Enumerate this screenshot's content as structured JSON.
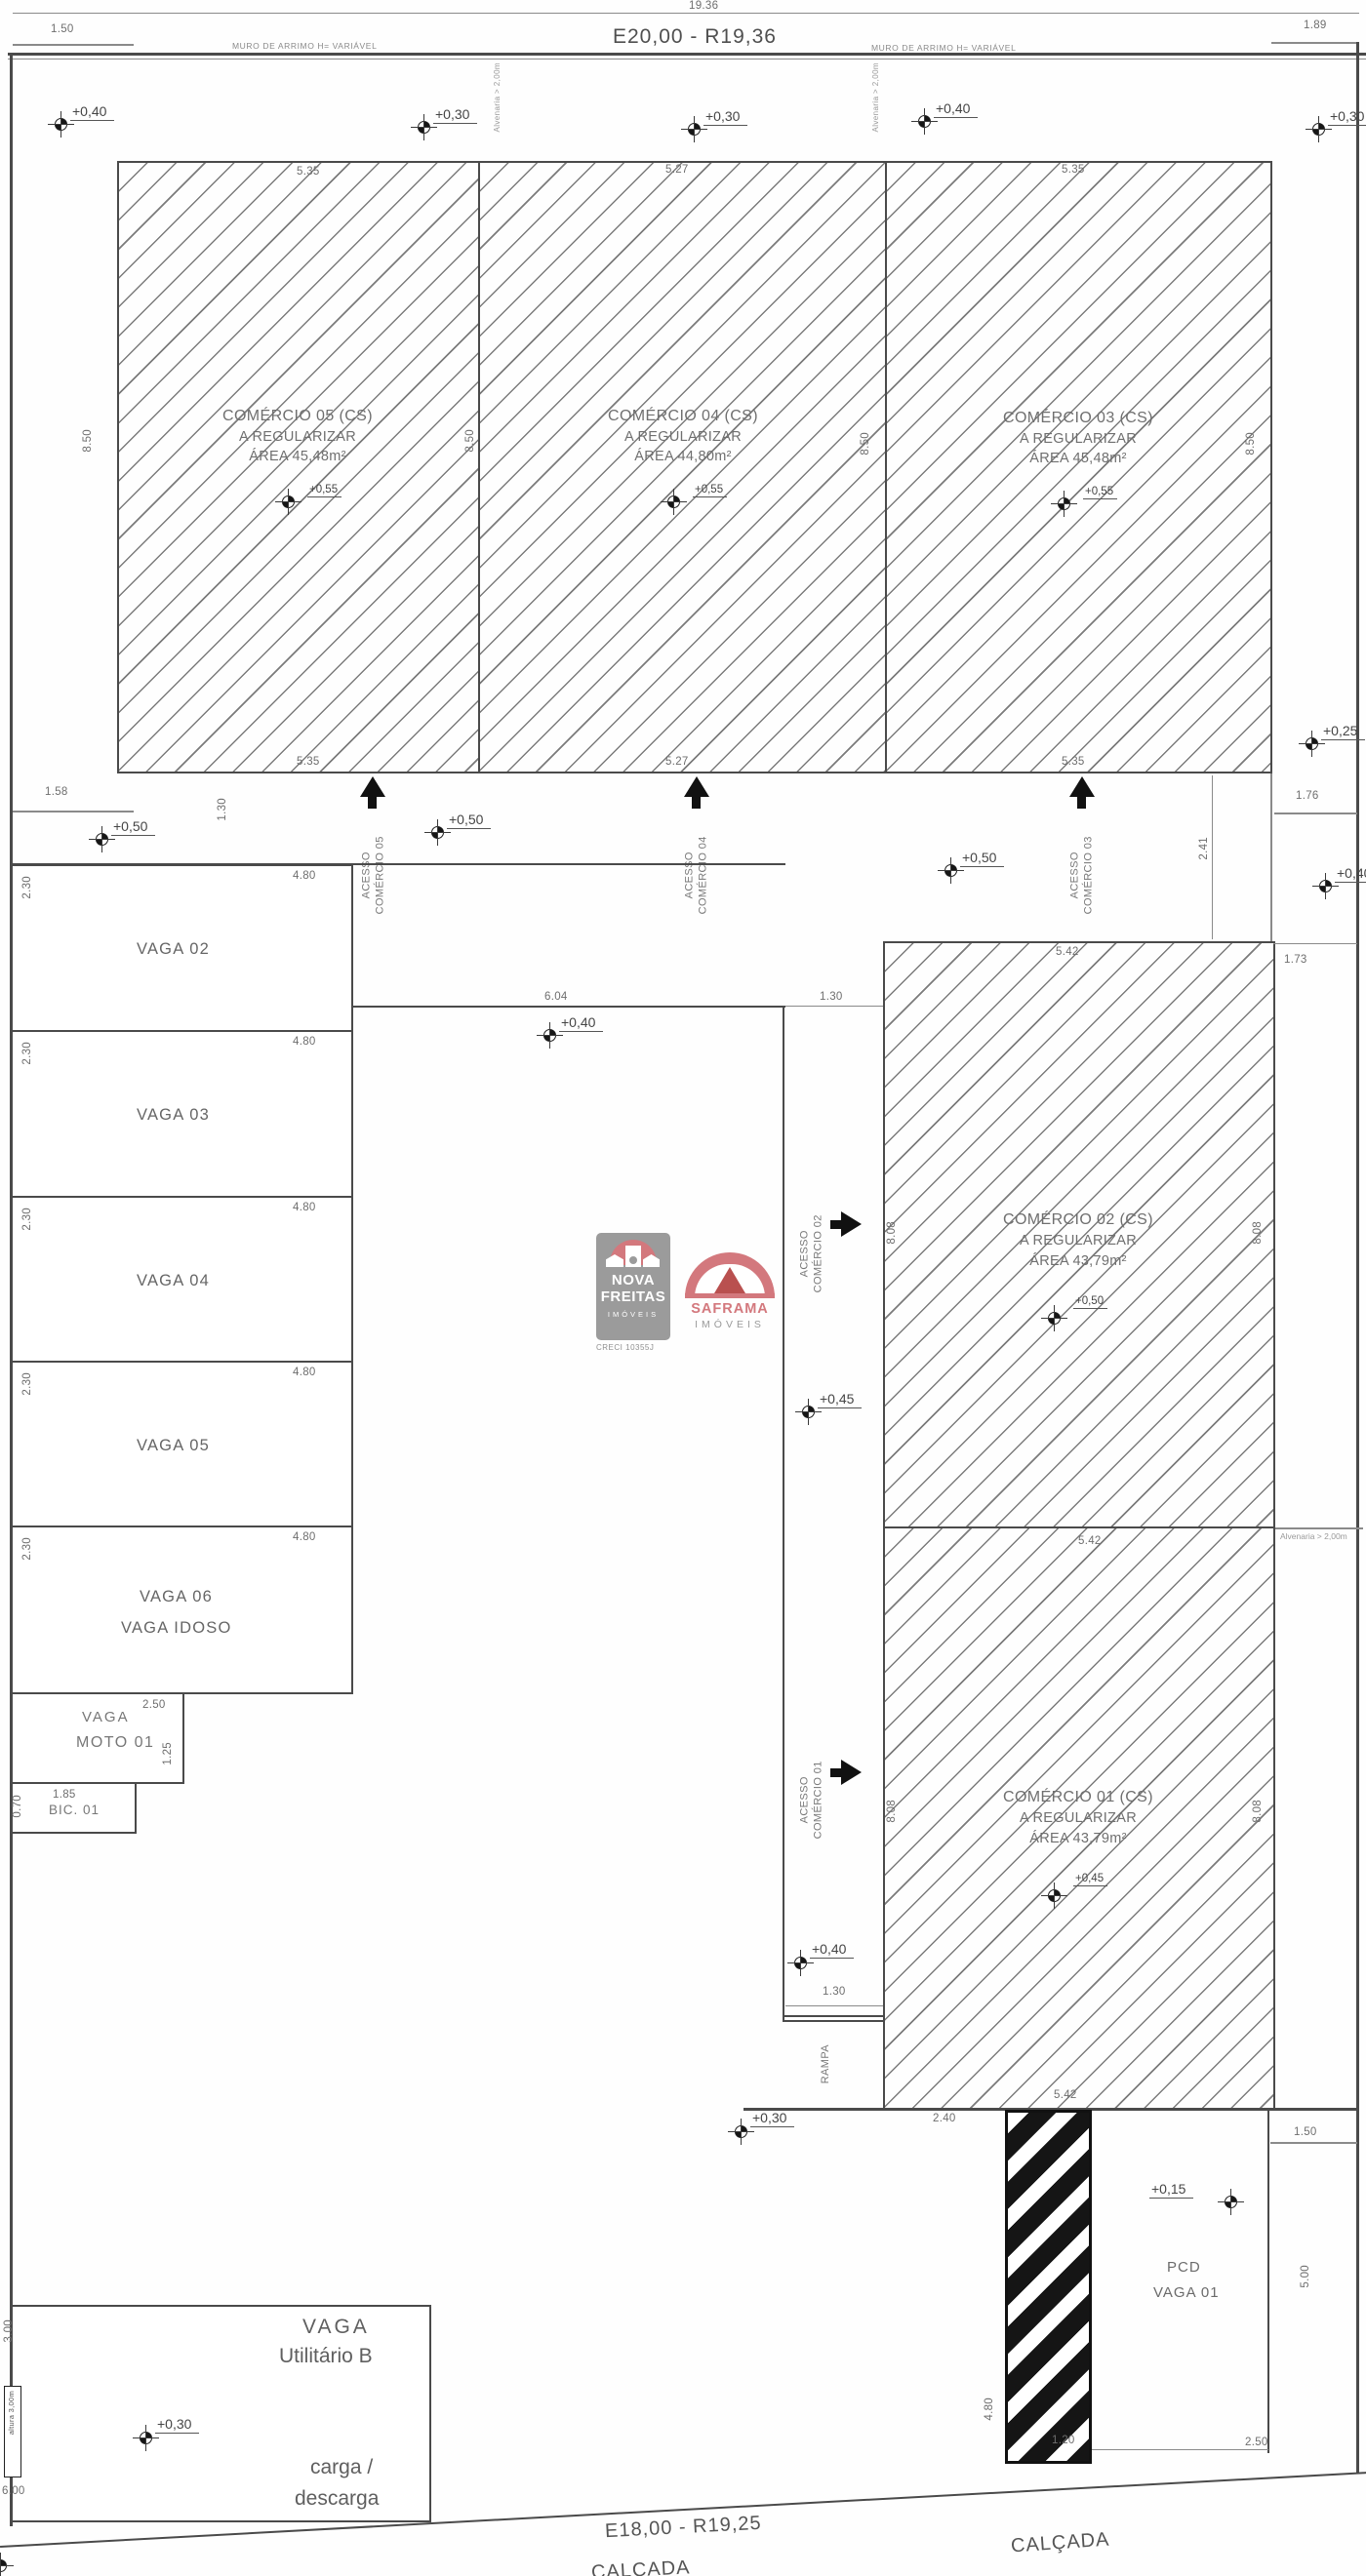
{
  "top": {
    "dim_total": "19.36",
    "dim_left": "1.50",
    "dim_right": "1.89",
    "title": "E20,00 - R19,36",
    "muro": "MURO DE ARRIMO H= VARIÁVEL",
    "alvenaria": "Alvenaria > 2,00m"
  },
  "levels": {
    "t1": "+0,40",
    "t2": "+0,30",
    "t3": "+0,30",
    "t4": "+0,40",
    "t5": "+0,30",
    "c1": "+0,50",
    "c2": "+0,50",
    "c3": "+0,50",
    "r1": "+0,25",
    "r2": "+0,40",
    "mid": "+0,40",
    "a2": "+0,45",
    "a1": "+0,40",
    "ramp": "+0,30",
    "pcd": "+0,15",
    "carga": "+0,30"
  },
  "units": {
    "u05": {
      "l1": "COMÉRCIO 05 (CS)",
      "l2": "A REGULARIZAR",
      "l3": "ÁREA 45,48m²",
      "lvl": "+0,55",
      "top": "5.35",
      "bottom": "5.35",
      "side": "8.50"
    },
    "u04": {
      "l1": "COMÉRCIO 04 (CS)",
      "l2": "A REGULARIZAR",
      "l3": "ÁREA 44,80m²",
      "lvl": "+0,55",
      "top": "5.27",
      "bottom": "5.27",
      "side": "8.50"
    },
    "u03": {
      "l1": "COMÉRCIO 03 (CS)",
      "l2": "A REGULARIZAR",
      "l3": "ÁREA 45,48m²",
      "lvl": "+0,55",
      "top": "5.35",
      "bottom": "5.35",
      "side": "8.50"
    },
    "u02": {
      "l1": "COMÉRCIO 02 (CS)",
      "l2": "A REGULARIZAR",
      "l3": "ÁREA 43,79m²",
      "lvl": "+0,50",
      "top": "5.42",
      "sl": "8.08",
      "sr": "8.08"
    },
    "u01": {
      "l1": "COMÉRCIO 01 (CS)",
      "l2": "A REGULARIZAR",
      "l3": "ÁREA 43,79m²",
      "lvl": "+0,45",
      "mid": "5.42",
      "bottom": "5.42",
      "sl": "8.08",
      "sr": "8.08"
    }
  },
  "acessos": {
    "a05a": "ACESSO",
    "a05b": "COMÉRCIO 05",
    "a04a": "ACESSO",
    "a04b": "COMÉRCIO 04",
    "a03a": "ACESSO",
    "a03b": "COMÉRCIO 03",
    "a02a": "ACESSO",
    "a02b": "COMÉRCIO 02",
    "a01a": "ACESSO",
    "a01b": "COMÉRCIO 01"
  },
  "vagas": {
    "v02": "VAGA 02",
    "v03": "VAGA 03",
    "v04": "VAGA 04",
    "v05": "VAGA 05",
    "v06": "VAGA 06",
    "v06b": "VAGA IDOSO",
    "w": "2.30",
    "l": "4.80"
  },
  "moto": {
    "a": "VAGA",
    "b": "MOTO 01",
    "top": "2.50",
    "side": "1.25"
  },
  "bic": {
    "label": "BIC. 01",
    "top": "1.85",
    "side": "0.70"
  },
  "dims": {
    "d158": "1.58",
    "d130l": "1.30",
    "d241": "2.41",
    "d176": "1.76",
    "d173": "1.73",
    "d604": "6.04",
    "d130m": "1.30",
    "d130r": "1.30",
    "d240": "2.40",
    "d150": "1.50",
    "d500": "5.00",
    "d480": "4.80",
    "d120": "1.20",
    "d250": "2.50",
    "d300": "3.00",
    "d600": "6.00"
  },
  "labels": {
    "rampa": "RAMPA",
    "alvenaria_r": "Alvenaria > 2,00m",
    "pcd1": "PCD",
    "pcd2": "VAGA 01",
    "util1": "VAGA",
    "util2": "Utilitário B",
    "carga1": "carga /",
    "carga2": "descarga",
    "altura": "altura 3,00m",
    "street": "E18,00 - R19,25",
    "calcada": "CALÇADA"
  },
  "logos": {
    "nova": {
      "l1": "NOVA",
      "l2": "FREITAS",
      "l3": "IMÓVEIS",
      "creci": "CRECI 10355J"
    },
    "saframa": {
      "name": "SAFRAMA",
      "sub": "IMÓVEIS"
    },
    "pink": "#d3787d",
    "gray": "#9b9b9b"
  }
}
